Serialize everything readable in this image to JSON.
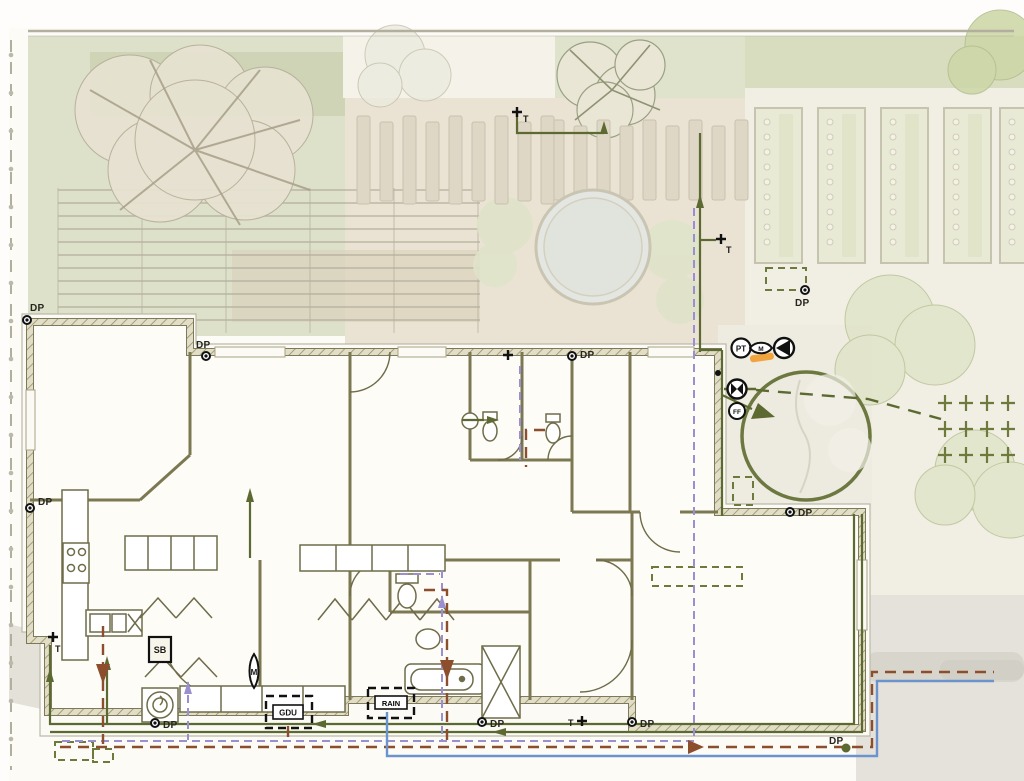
{
  "plan": {
    "labels": {
      "downpipe": "DP",
      "tap": "T",
      "pressure_tank": "PT",
      "meter": "M",
      "first_flush": "FF",
      "sink_box": "SB",
      "gdu": "GDU",
      "rain": "RAIN"
    },
    "downpipes": [
      {
        "x": 27,
        "y": 320,
        "lx": 30,
        "ly": 311
      },
      {
        "x": 206,
        "y": 356,
        "lx": 196,
        "ly": 348
      },
      {
        "x": 572,
        "y": 356,
        "lx": 580,
        "ly": 358
      },
      {
        "x": 805,
        "y": 290,
        "lx": 795,
        "ly": 306
      },
      {
        "x": 30,
        "y": 508,
        "lx": 38,
        "ly": 505
      },
      {
        "x": 790,
        "y": 512,
        "lx": 798,
        "ly": 516
      },
      {
        "x": 846,
        "y": 748,
        "lx": 829,
        "ly": 744,
        "variant": "green"
      },
      {
        "x": 155,
        "y": 723,
        "lx": 163,
        "ly": 728
      },
      {
        "x": 482,
        "y": 722,
        "lx": 490,
        "ly": 727
      },
      {
        "x": 632,
        "y": 722,
        "lx": 640,
        "ly": 727
      }
    ],
    "taps": [
      {
        "x": 517,
        "y": 112,
        "lx": 523,
        "ly": 122
      },
      {
        "x": 721,
        "y": 239,
        "lx": 726,
        "ly": 253
      },
      {
        "x": 582,
        "y": 721,
        "lx": 568,
        "ly": 726
      },
      {
        "x": 53,
        "y": 637,
        "lx": 55,
        "ly": 652
      },
      {
        "x": 508,
        "y": 355,
        "nolabel": true
      }
    ],
    "espalier_grid": {
      "x": 945,
      "y": 403,
      "cols": 4,
      "rows": 3,
      "dx": 21,
      "dy": 26
    },
    "colors": {
      "irrigation_green": "#5c6a32",
      "greywater_purple": "#9b90cf",
      "sewer_brown": "#8c4e2c",
      "mains_blue": "#6b93cd",
      "wall_olive": "#6f6c49",
      "highlight_orange": "#f1a43e",
      "lawn_green": "#dde1ca",
      "paving_beige": "#eae3d4",
      "pond_grey": "#e4e7e1"
    }
  }
}
